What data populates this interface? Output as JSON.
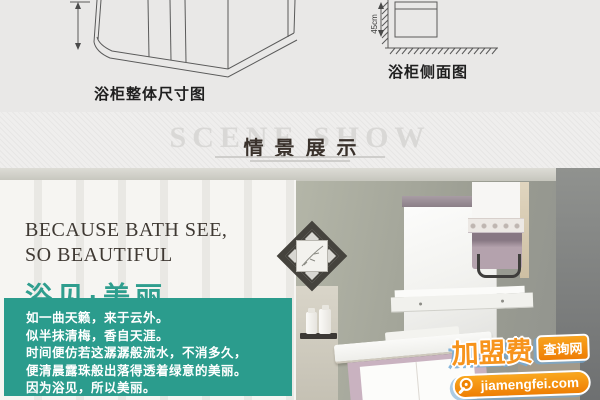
{
  "diagram_section": {
    "overall_label": "浴柜整体尺寸图",
    "side_label": "浴柜侧面图",
    "side_dimension": "45cm"
  },
  "scene_banner": {
    "title_en": "SCENE SHOW",
    "title_zh": "情景展示"
  },
  "hero": {
    "headline_en_line1": "BECAUSE BATH SEE,",
    "headline_en_line2": "SO BEAUTIFUL",
    "headline_zh": "浴见·美丽",
    "poem": [
      "如一曲天籁，来于云外。",
      "似半抹清梅，香自天涯。",
      "时间便仿若这潺潺般流水，不消多久，",
      "便清晨露珠般出落得透着绿意的美丽。",
      "因为浴见，所以美丽。"
    ]
  },
  "watermark": {
    "brand_main": "加盟费",
    "brand_tag": "查询网",
    "domain": "jiamengfei.com"
  },
  "colors": {
    "teal_box": "#2b9c8d",
    "headline_teal": "#2f9e8e",
    "watermark_orange": "#f7941d",
    "watermark_orange_deep": "#ef7d04",
    "banner_text_dark": "#3a322c"
  }
}
